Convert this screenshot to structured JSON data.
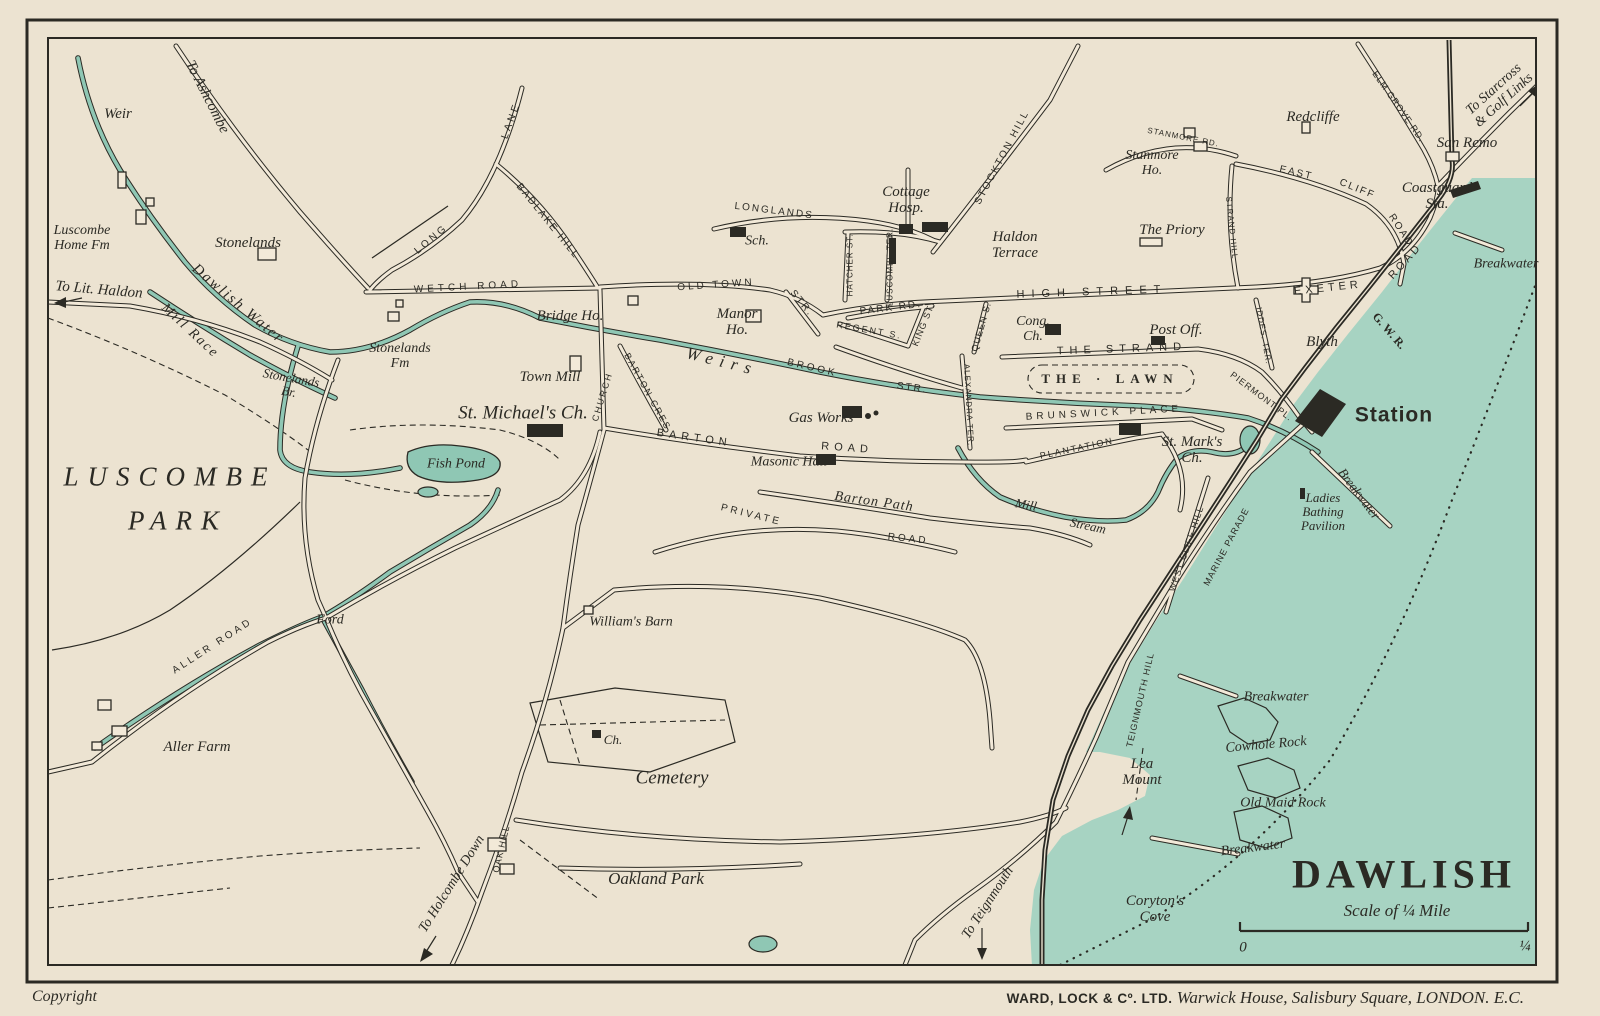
{
  "page": {
    "copyright": "Copyright",
    "imprint_bold": "WARD, LOCK & Cº. LTD.",
    "imprint_italic": "Warwick House, Salisbury Square, LONDON. E.C."
  },
  "map": {
    "title": "DAWLISH",
    "scale": {
      "label": "Scale of ¼ Mile",
      "start": "0",
      "end": "¼"
    },
    "colors": {
      "paper": "#ece3d1",
      "sea": "#a7d3c2",
      "stream": "#8fc7b4",
      "ink": "#2b2a24",
      "road_fill": "#f2e9d8"
    },
    "labels": [
      {
        "t": "Weir",
        "c": "place",
        "x": 118,
        "y": 114,
        "s": 15
      },
      {
        "t": "To Ashcombe",
        "c": "dest",
        "x": 207,
        "y": 97,
        "r": 63,
        "s": 15
      },
      {
        "t": "Luscombe\nHome Fm",
        "c": "place",
        "x": 82,
        "y": 238,
        "s": 14
      },
      {
        "t": "To Lit. Haldon",
        "c": "dest",
        "x": 99,
        "y": 290,
        "r": 5,
        "s": 15
      },
      {
        "t": "Stonelands",
        "c": "place",
        "x": 248,
        "y": 243,
        "s": 15
      },
      {
        "t": "Dawlish Water",
        "c": "water",
        "x": 238,
        "y": 304,
        "r": 40,
        "s": 15,
        "ls": 2
      },
      {
        "t": "Mill Race",
        "c": "water",
        "x": 190,
        "y": 331,
        "r": 43,
        "s": 14,
        "ls": 2
      },
      {
        "t": "Stonelands\nBr.",
        "c": "place",
        "x": 290,
        "y": 385,
        "r": 10,
        "s": 13
      },
      {
        "t": "LUSCOMBE",
        "c": "park",
        "x": 170,
        "y": 477,
        "s": 27,
        "ls": 9
      },
      {
        "t": "PARK",
        "c": "park",
        "x": 178,
        "y": 521,
        "s": 27,
        "ls": 9
      },
      {
        "t": "Ford",
        "c": "place",
        "x": 330,
        "y": 620,
        "s": 14
      },
      {
        "t": "ALLER ROAD",
        "c": "road",
        "x": 213,
        "y": 647,
        "r": -33,
        "s": 10,
        "ls": 3
      },
      {
        "t": "Aller Farm",
        "c": "place",
        "x": 197,
        "y": 747,
        "s": 15
      },
      {
        "t": "LONG",
        "c": "road",
        "x": 432,
        "y": 240,
        "r": -40,
        "s": 10,
        "ls": 3
      },
      {
        "t": "LANE",
        "c": "road",
        "x": 512,
        "y": 121,
        "r": -70,
        "s": 10,
        "ls": 3
      },
      {
        "t": "BADLAKE HILL",
        "c": "road",
        "x": 547,
        "y": 222,
        "r": 51,
        "s": 10,
        "ls": 2
      },
      {
        "t": "WETCH ROAD",
        "c": "road",
        "x": 468,
        "y": 288,
        "r": -3,
        "s": 10,
        "ls": 4
      },
      {
        "t": "Stonelands\nFm",
        "c": "place",
        "x": 400,
        "y": 356,
        "s": 14
      },
      {
        "t": "Bridge Ho.",
        "c": "place",
        "x": 570,
        "y": 316,
        "s": 15
      },
      {
        "t": "Town Mill",
        "c": "place",
        "x": 550,
        "y": 377,
        "s": 15
      },
      {
        "t": "St. Michael's Ch.",
        "c": "place",
        "x": 523,
        "y": 414,
        "s": 19
      },
      {
        "t": "CHURCH",
        "c": "road",
        "x": 603,
        "y": 397,
        "r": -73,
        "s": 9,
        "ls": 2
      },
      {
        "t": "BARTON CRES",
        "c": "road",
        "x": 647,
        "y": 392,
        "r": 61,
        "s": 9,
        "ls": 2
      },
      {
        "t": "Weirs",
        "c": "water",
        "x": 722,
        "y": 362,
        "r": 14,
        "s": 17,
        "ls": 7
      },
      {
        "t": "BROOK",
        "c": "road",
        "x": 812,
        "y": 369,
        "r": 13,
        "s": 10,
        "ls": 3
      },
      {
        "t": "STR.",
        "c": "road",
        "x": 912,
        "y": 389,
        "r": 8,
        "s": 10,
        "ls": 2
      },
      {
        "t": "OLD TOWN",
        "c": "road",
        "x": 716,
        "y": 286,
        "r": -4,
        "s": 10,
        "ls": 3
      },
      {
        "t": "STR.",
        "c": "road",
        "x": 801,
        "y": 304,
        "r": 50,
        "s": 10,
        "ls": 2
      },
      {
        "t": "Manor\nHo.",
        "c": "place",
        "x": 737,
        "y": 322,
        "s": 15
      },
      {
        "t": "LONGLANDS",
        "c": "road",
        "x": 774,
        "y": 212,
        "r": 7,
        "s": 10,
        "ls": 2
      },
      {
        "t": "Sch.",
        "c": "place",
        "x": 757,
        "y": 241,
        "s": 14
      },
      {
        "t": "Cottage\nHosp.",
        "c": "place",
        "x": 906,
        "y": 200,
        "s": 15
      },
      {
        "t": "STOCKTON HILL",
        "c": "road",
        "x": 1003,
        "y": 158,
        "r": -62,
        "s": 10,
        "ls": 2
      },
      {
        "t": "HATCHER ST.",
        "c": "road",
        "x": 851,
        "y": 265,
        "r": -90,
        "s": 8,
        "ls": 1
      },
      {
        "t": "LUSCOMBE TER.",
        "c": "road",
        "x": 891,
        "y": 267,
        "r": -90,
        "s": 8,
        "ls": 1
      },
      {
        "t": "Haldon\nTerrace",
        "c": "place",
        "x": 1015,
        "y": 245,
        "s": 15
      },
      {
        "t": "PARK RD.",
        "c": "road",
        "x": 891,
        "y": 309,
        "r": -7,
        "s": 10,
        "ls": 2
      },
      {
        "t": "REGENT S.",
        "c": "road",
        "x": 869,
        "y": 331,
        "r": 10,
        "s": 9,
        "ls": 2
      },
      {
        "t": "KING ST.",
        "c": "road",
        "x": 924,
        "y": 325,
        "r": -68,
        "s": 9,
        "ls": 1
      },
      {
        "t": "QUEEN S.",
        "c": "road",
        "x": 982,
        "y": 327,
        "r": -74,
        "s": 9,
        "ls": 1
      },
      {
        "t": "HIGH STREET",
        "c": "road",
        "x": 1092,
        "y": 293,
        "r": -2,
        "s": 11,
        "ls": 7
      },
      {
        "t": "Cong.\nCh.",
        "c": "place",
        "x": 1033,
        "y": 329,
        "s": 14
      },
      {
        "t": "Post Off.",
        "c": "place",
        "x": 1176,
        "y": 330,
        "s": 15
      },
      {
        "t": "THE STRAND",
        "c": "road",
        "x": 1122,
        "y": 350,
        "r": -2,
        "s": 11,
        "ls": 6
      },
      {
        "t": "THE · LAWN",
        "c": "lawn",
        "x": 1110,
        "y": 379,
        "s": 13,
        "ls": 6
      },
      {
        "t": "BRUNSWICK PLACE",
        "c": "road",
        "x": 1104,
        "y": 414,
        "r": -3,
        "s": 10,
        "ls": 4
      },
      {
        "t": "Gas Works",
        "c": "place",
        "x": 821,
        "y": 418,
        "s": 15
      },
      {
        "t": "BARTON",
        "c": "road",
        "x": 694,
        "y": 439,
        "r": 8,
        "s": 11,
        "ls": 5
      },
      {
        "t": "ROAD",
        "c": "road",
        "x": 847,
        "y": 449,
        "r": 4,
        "s": 11,
        "ls": 5
      },
      {
        "t": "Masonic Hall",
        "c": "place",
        "x": 789,
        "y": 462,
        "s": 14
      },
      {
        "t": "Barton Path",
        "c": "place",
        "x": 874,
        "y": 502,
        "r": 8,
        "s": 14,
        "ls": 1
      },
      {
        "t": "PLANTATION",
        "c": "road",
        "x": 1077,
        "y": 449,
        "r": -12,
        "s": 9,
        "ls": 2
      },
      {
        "t": "ALEXANDRA TER.",
        "c": "road",
        "x": 968,
        "y": 405,
        "r": 87,
        "s": 8,
        "ls": 1
      },
      {
        "t": "St. Mark's\nCh.",
        "c": "place",
        "x": 1192,
        "y": 450,
        "s": 15
      },
      {
        "t": "PIERMONT PL.",
        "c": "road",
        "x": 1261,
        "y": 397,
        "r": 37,
        "s": 9,
        "ls": 1
      },
      {
        "t": "IDDES. TER.",
        "c": "road",
        "x": 1263,
        "y": 336,
        "r": 80,
        "s": 8,
        "ls": 1
      },
      {
        "t": "Blyth",
        "c": "place",
        "x": 1322,
        "y": 342,
        "s": 15
      },
      {
        "t": "G. W. R.",
        "c": "rail",
        "x": 1389,
        "y": 331,
        "r": 49,
        "s": 12
      },
      {
        "t": "EXETER",
        "c": "road",
        "x": 1328,
        "y": 289,
        "r": -6,
        "s": 11,
        "ls": 4
      },
      {
        "t": "ROAD",
        "c": "road",
        "x": 1406,
        "y": 262,
        "r": -48,
        "s": 11,
        "ls": 3
      },
      {
        "t": "EAST",
        "c": "road",
        "x": 1296,
        "y": 174,
        "r": 13,
        "s": 10,
        "ls": 2
      },
      {
        "t": "CLIFF",
        "c": "road",
        "x": 1357,
        "y": 190,
        "r": 22,
        "s": 10,
        "ls": 2
      },
      {
        "t": "ROAD",
        "c": "road",
        "x": 1400,
        "y": 231,
        "r": 57,
        "s": 10,
        "ls": 2
      },
      {
        "t": "STANMORE RD.",
        "c": "road",
        "x": 1183,
        "y": 138,
        "r": 11,
        "s": 8,
        "ls": 1
      },
      {
        "t": "Stanmore\nHo.",
        "c": "place",
        "x": 1152,
        "y": 163,
        "s": 14
      },
      {
        "t": "Redcliffe",
        "c": "place",
        "x": 1313,
        "y": 117,
        "s": 15
      },
      {
        "t": "The Priory",
        "c": "place",
        "x": 1172,
        "y": 230,
        "s": 15
      },
      {
        "t": "STRAND HILL",
        "c": "road",
        "x": 1231,
        "y": 228,
        "r": 84,
        "s": 8,
        "ls": 1
      },
      {
        "t": "ELM GROVE RD.",
        "c": "road",
        "x": 1398,
        "y": 107,
        "r": 55,
        "s": 9,
        "ls": 1
      },
      {
        "t": "To Starcross\n& Golf Links",
        "c": "dest",
        "x": 1499,
        "y": 95,
        "r": -42,
        "s": 14
      },
      {
        "t": "San Remo",
        "c": "place",
        "x": 1467,
        "y": 143,
        "s": 15
      },
      {
        "t": "Coastguard\nSta.",
        "c": "place",
        "x": 1437,
        "y": 196,
        "s": 15
      },
      {
        "t": "Breakwater",
        "c": "place",
        "x": 1506,
        "y": 264,
        "s": 14
      },
      {
        "t": "Station",
        "c": "station",
        "x": 1394,
        "y": 416,
        "s": 21,
        "ls": 1
      },
      {
        "t": "Breakwater",
        "c": "place",
        "x": 1359,
        "y": 494,
        "r": 53,
        "s": 13
      },
      {
        "t": "Ladies\nBathing\nPavilion",
        "c": "place",
        "x": 1323,
        "y": 512,
        "s": 13
      },
      {
        "t": "WEST CLIFF HILL",
        "c": "road",
        "x": 1187,
        "y": 549,
        "r": -71,
        "s": 9,
        "ls": 1
      },
      {
        "t": "MARINE PARADE",
        "c": "road",
        "x": 1227,
        "y": 547,
        "r": -62,
        "s": 9,
        "ls": 1
      },
      {
        "t": "TEIGNMOUTH HILL",
        "c": "road",
        "x": 1141,
        "y": 700,
        "r": -77,
        "s": 9,
        "ls": 1
      },
      {
        "t": "Lea\nMount",
        "c": "place",
        "x": 1142,
        "y": 772,
        "s": 15
      },
      {
        "t": "Breakwater",
        "c": "place",
        "x": 1276,
        "y": 697,
        "s": 14
      },
      {
        "t": "Cowhole Rock",
        "c": "place",
        "x": 1266,
        "y": 745,
        "r": -5,
        "s": 14
      },
      {
        "t": "Old Maid Rock",
        "c": "place",
        "x": 1283,
        "y": 803,
        "s": 14
      },
      {
        "t": "Breakwater",
        "c": "place",
        "x": 1253,
        "y": 848,
        "r": -7,
        "s": 14
      },
      {
        "t": "Coryton's\nCove",
        "c": "place",
        "x": 1155,
        "y": 909,
        "s": 15
      },
      {
        "t": "To Teignmouth",
        "c": "dest",
        "x": 988,
        "y": 903,
        "r": -57,
        "s": 14
      },
      {
        "t": "Cemetery",
        "c": "area",
        "x": 672,
        "y": 779,
        "s": 19
      },
      {
        "t": "Ch.",
        "c": "place",
        "x": 613,
        "y": 740,
        "s": 13
      },
      {
        "t": "William's Barn",
        "c": "place",
        "x": 631,
        "y": 622,
        "s": 14
      },
      {
        "t": "Oakland Park",
        "c": "area",
        "x": 656,
        "y": 879,
        "s": 17
      },
      {
        "t": "To Holcombe Down",
        "c": "dest",
        "x": 452,
        "y": 884,
        "r": -58,
        "s": 14
      },
      {
        "t": "OAK HILL",
        "c": "road",
        "x": 502,
        "y": 849,
        "r": -77,
        "s": 9,
        "ls": 1
      },
      {
        "t": "Fish Pond",
        "c": "water",
        "x": 456,
        "y": 464,
        "s": 14
      },
      {
        "t": "Mill",
        "c": "water",
        "x": 1026,
        "y": 505,
        "r": 10,
        "s": 13
      },
      {
        "t": "Stream",
        "c": "water",
        "x": 1088,
        "y": 526,
        "r": 12,
        "s": 13
      },
      {
        "t": "PRIVATE",
        "c": "road",
        "x": 751,
        "y": 516,
        "r": 14,
        "s": 10,
        "ls": 3
      },
      {
        "t": "ROAD",
        "c": "road",
        "x": 908,
        "y": 540,
        "r": 6,
        "s": 10,
        "ls": 3
      }
    ]
  }
}
